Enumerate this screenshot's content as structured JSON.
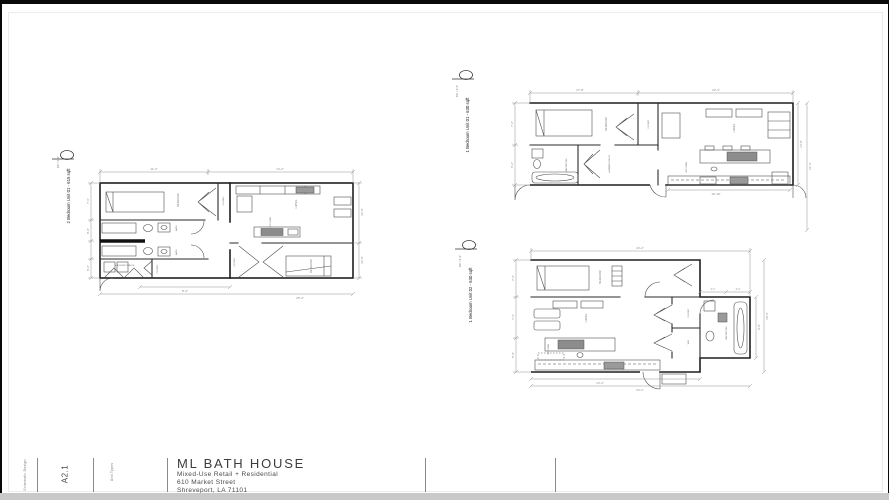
{
  "sheet": {
    "title_block": {
      "project_name": "ML BATH HOUSE",
      "project_subtitle": "Mixed-Use Retail + Residential",
      "address_line1": "610 Market Street",
      "address_line2": "Shreveport, LA 71101",
      "sheet_number": "A2.1",
      "stamp_left": "Schematic Design",
      "stamp_mid": "Unit Types"
    },
    "plans": {
      "p1": {
        "label": "2 Bedroom Unit 01 - 615 sqft",
        "scale": "1/4\" = 1'-0\"",
        "rooms": {
          "bedroom1": "BEDROOM",
          "closet1": "CLOSET",
          "bath1": "BATH",
          "bath2": "BATH",
          "laundry": "LAUNDRY/MECH",
          "closet2": "CLOSET",
          "living": "LIVING",
          "kitchen": "KITCHEN",
          "bedroom2": "BEDROOM",
          "closet3": "CLOSET"
        },
        "dims": {
          "top1": "11'-2\"",
          "top2": "14'-2\"",
          "left1": "7'-6\"",
          "left2": "8'-0\"",
          "left3": "8'-6\"",
          "right1": "12'-0\"",
          "right2": "12'-0\"",
          "bottom1": "8'-4\"",
          "bottom2": "25'-4\""
        }
      },
      "p2": {
        "label": "1 Bedroom Unit 01 - 630 sqft",
        "scale": "1/4\" = 1'-0\"",
        "rooms": {
          "bedroom": "BEDROOM",
          "closet": "CLOSET",
          "bathroom": "BATHROOM",
          "laundry": "LAUNDRY/MECH",
          "living": "LIVING",
          "kitchen": "KITCHEN"
        },
        "dims": {
          "top1": "17'-8\"",
          "top2": "22'-4\"",
          "left1": "7'-6\"",
          "left2": "6'-2\"",
          "right1": "13'-8\"",
          "right2": "21'-6\"",
          "bottom1": "19'-10\""
        }
      },
      "p3": {
        "label": "1 Bedroom Unit 02 - 630 sqft",
        "scale": "1/4\" = 1'-0\"",
        "rooms": {
          "bedroom": "BEDROOM",
          "living": "LIVING",
          "kitchen": "KITCHEN",
          "closet": "CLOSET",
          "wd": "W/D",
          "bathroom": "BATHROOM"
        },
        "dims": {
          "top1": "24'-2\"",
          "left1": "7'-6\"",
          "left2": "7'-2\"",
          "left3": "5'-8\"",
          "right1": "9'-8\"",
          "right2": "18'-6\"",
          "bottom1": "14'-4\"",
          "bottom2": "24'-2\"",
          "bath1": "2'-1\"",
          "bath2": "4'-2\""
        }
      }
    }
  }
}
